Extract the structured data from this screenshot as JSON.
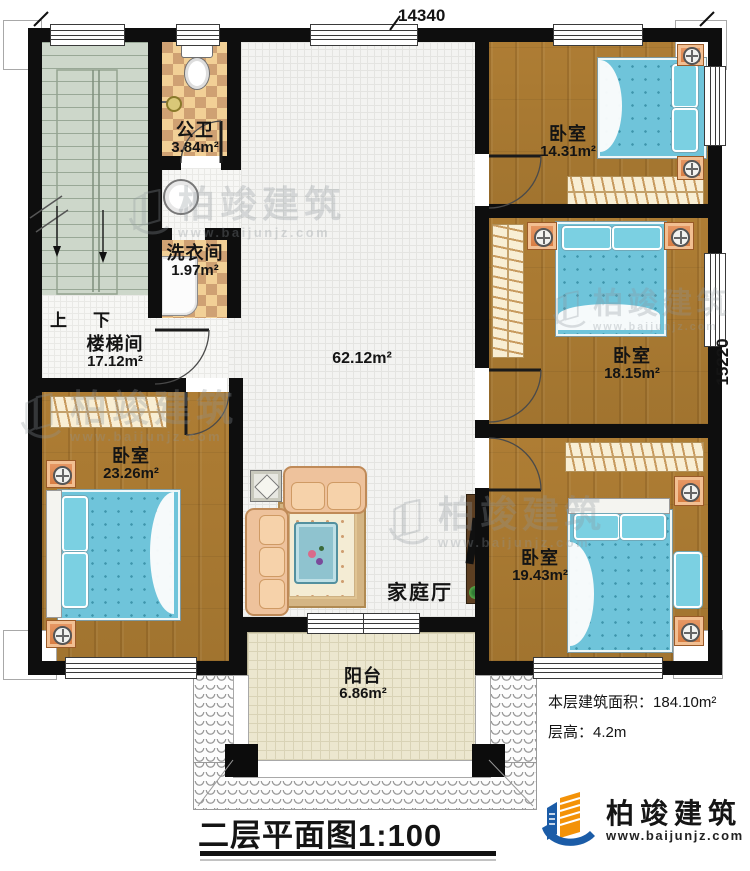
{
  "plan": {
    "dimensions": {
      "width_mm": "14340",
      "height_mm": "15220"
    },
    "rooms": {
      "public_bath": {
        "name": "公卫",
        "area": "3.84m²"
      },
      "laundry": {
        "name": "洗衣间",
        "area": "1.97m²"
      },
      "stairwell": {
        "name": "楼梯间",
        "area": "17.12m²"
      },
      "family_hall": {
        "name": "家庭厅",
        "area": "62.12m²"
      },
      "bedroom_top_right": {
        "name": "卧室",
        "area": "14.31m²"
      },
      "bedroom_right": {
        "name": "卧室",
        "area": "18.15m²"
      },
      "bedroom_bottom_right": {
        "name": "卧室",
        "area": "19.43m²"
      },
      "bedroom_bottom_left": {
        "name": "卧室",
        "area": "23.26m²"
      },
      "balcony": {
        "name": "阳台",
        "area": "6.86m²"
      }
    },
    "stair_marks": {
      "up": "上",
      "down": "下"
    }
  },
  "notes": {
    "floor_area_label": "本层建筑面积：",
    "floor_area_value": "184.10m²",
    "floor_height_label": "层高：",
    "floor_height_value": "4.2m"
  },
  "title": {
    "name": "二层平面图",
    "scale": "1:100"
  },
  "brand": {
    "name": "柏竣建筑",
    "website": "www.baijunjz.com"
  },
  "watermark": {
    "name": "柏竣建筑",
    "website": "www.baijunjz.com"
  },
  "colors": {
    "wall": "#0e0e0e",
    "wood_floor": "#a97b33",
    "hall_tile": "#f3f3f1",
    "bed": "#6fc4da",
    "checker_light": "#f2d096",
    "checker_dark": "#cfa173",
    "stair": "#cdd7ca",
    "balcony_tile": "#ece7cf",
    "brand_blue": "#1b5ca7",
    "brand_orange": "#f39208"
  }
}
